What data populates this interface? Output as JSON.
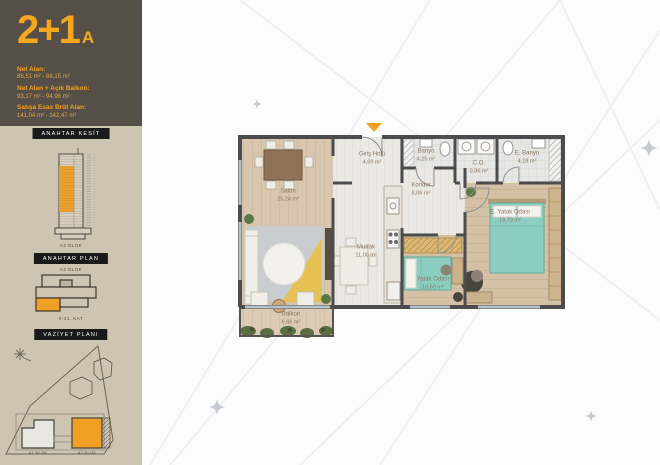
{
  "unit": {
    "type": "2+1",
    "variant": "A"
  },
  "sidebar": {
    "header": {
      "stats": [
        {
          "label": "Net Alan:",
          "value": "86,51 m² - 88,15 m²"
        },
        {
          "label": "Net Alan + Açık Balkon:",
          "value": "93,17 m² - 94,96 m²"
        },
        {
          "label": "Satışa Esas Brüt Alan:",
          "value": "141,04 m² - 142,47 m²"
        }
      ]
    },
    "key_section": {
      "title": "ANAHTAR KESİT",
      "caption": "A2 BLOK"
    },
    "key_plan": {
      "title": "ANAHTAR PLAN",
      "block_label": "A2 BLOK",
      "floor_label": "0-31. KAT"
    },
    "site_plan": {
      "title": "VAZİYET PLANI",
      "block_a1": "A1 BLOK",
      "block_a2": "A2 BLOK"
    }
  },
  "floor_plan": {
    "rooms": [
      {
        "name": "Salon",
        "area": "25,24 m²"
      },
      {
        "name": "Giriş Holü",
        "area": "4,69 m²"
      },
      {
        "name": "Mutfak",
        "area": "11,00 m²"
      },
      {
        "name": "Koridor",
        "area": "8,06 m²"
      },
      {
        "name": "Banyo",
        "area": "4,25 m²"
      },
      {
        "name": "C.O.",
        "area": "0,86 m²"
      },
      {
        "name": "E. Banyo",
        "area": "4,18 m²"
      },
      {
        "name": "E. Yatak Odası",
        "area": "16,73 m²"
      },
      {
        "name": "Yatak Odası",
        "area": "10,68 m²"
      },
      {
        "name": "Balkon",
        "area": "6,66 m²"
      }
    ],
    "colors": {
      "accent_orange": "#f0a125",
      "wall": "#4c4b4d",
      "wood_floor": "#d8c6ae",
      "bed_teal": "#8ccfc2",
      "sidebar_dark": "#564f47",
      "sidebar_beige": "#cdc4b1"
    }
  }
}
